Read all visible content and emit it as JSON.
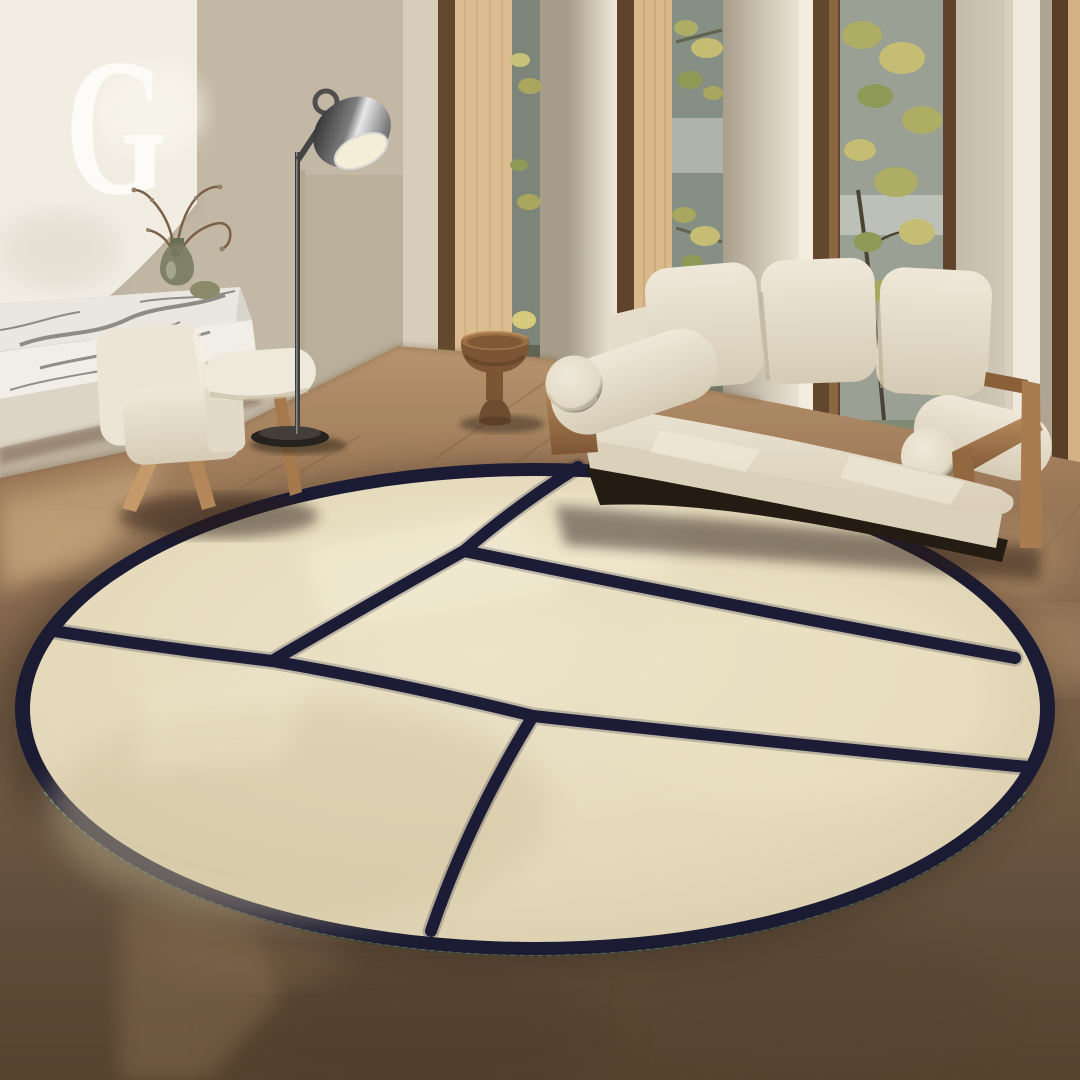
{
  "overlay": {
    "letter": "G",
    "letter_color": "#fcfbf8",
    "letter_style": "white serif capital, top-left corner"
  },
  "scene": {
    "type": "product-photo",
    "subject": "round cream area rug with abstract navy line pattern",
    "setting": "sunlit modern living room",
    "rug": {
      "shape": "round, seen in perspective as ellipse",
      "field_color": "#e6dcc0",
      "line_color": "#1b1b33",
      "border": "navy ring around circumference",
      "trim": "olive-grey serged zigzag edge along lower rim",
      "pattern": "navy lines divide the circle into five irregular panels: short stub from top edge to a junction, diagonal to a left junction, line to left rim, long line to right rim, lower line to right rim, and a line down to the bottom rim"
    },
    "objects": [
      {
        "name": "sofa",
        "desc": "cream boucle 3-seat sofa with bolster arms and oak frame, in front of tall windows"
      },
      {
        "name": "armchair",
        "desc": "cream boucle lounge chair with wooden compass legs"
      },
      {
        "name": "floor-lamp",
        "desc": "chrome dome-shade floor lamp with thin stem and round dark base"
      },
      {
        "name": "side-table",
        "desc": "walnut pedestal side table with bowl-shaped top"
      },
      {
        "name": "marble-bench",
        "desc": "low white marble slab bench with grey veining and dark fireplace slot"
      },
      {
        "name": "fireplace-wall",
        "desc": "white plaster chimney volume, top-left"
      },
      {
        "name": "vase",
        "desc": "green glass vase with dry branches on the marble bench"
      },
      {
        "name": "windows",
        "desc": "floor-to-ceiling slot windows with oak jambs, greenery outside"
      },
      {
        "name": "floor",
        "desc": "warm brown mottled floor, lighter wood tone near windows"
      }
    ],
    "palette": {
      "rug_cream": "#e6dcc0",
      "rug_navy": "#1b1b33",
      "serge_olive": "#6e7360",
      "wall_beige": "#c3b8a5",
      "plaster_white": "#f1ede3",
      "oak_wood": "#d9b88c",
      "dark_frame": "#5e422a",
      "sofa_cream": "#eae3d2",
      "floor_brown": "#7c6149",
      "foliage_green": "#adad66"
    }
  }
}
